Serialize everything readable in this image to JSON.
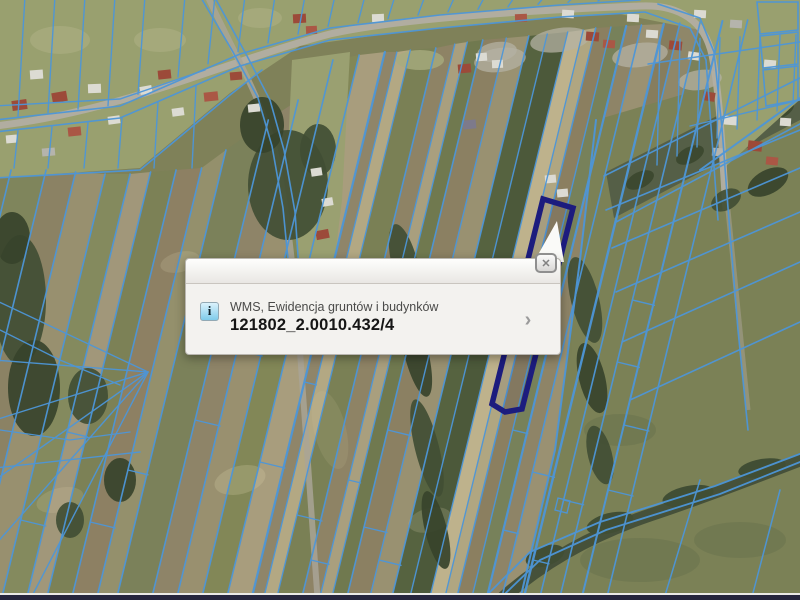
{
  "app": {
    "type": "gis-aerial-map-viewer"
  },
  "map": {
    "selected_parcel": {
      "id": "121802_2.0010.432/4"
    },
    "colors": {
      "cadastral_line": "#4d96d8",
      "selected_outline": "#1c1c7e",
      "field_base": "#7f8159",
      "village_base": "#99a06f",
      "right_field": "#7b8156",
      "dark_band": "#555f47",
      "tree": "#414e34",
      "tree_dark": "#37432b",
      "road": "#b2aea2",
      "stream": "#46513a"
    }
  },
  "popup": {
    "layer_title": "WMS, Ewidencja gruntów i budynków",
    "parcel_id": "121802_2.0010.432/4",
    "icons": {
      "info": "i",
      "close": "✕",
      "chevron": "›"
    }
  },
  "bottom_bar": {
    "color": "#26263e"
  }
}
